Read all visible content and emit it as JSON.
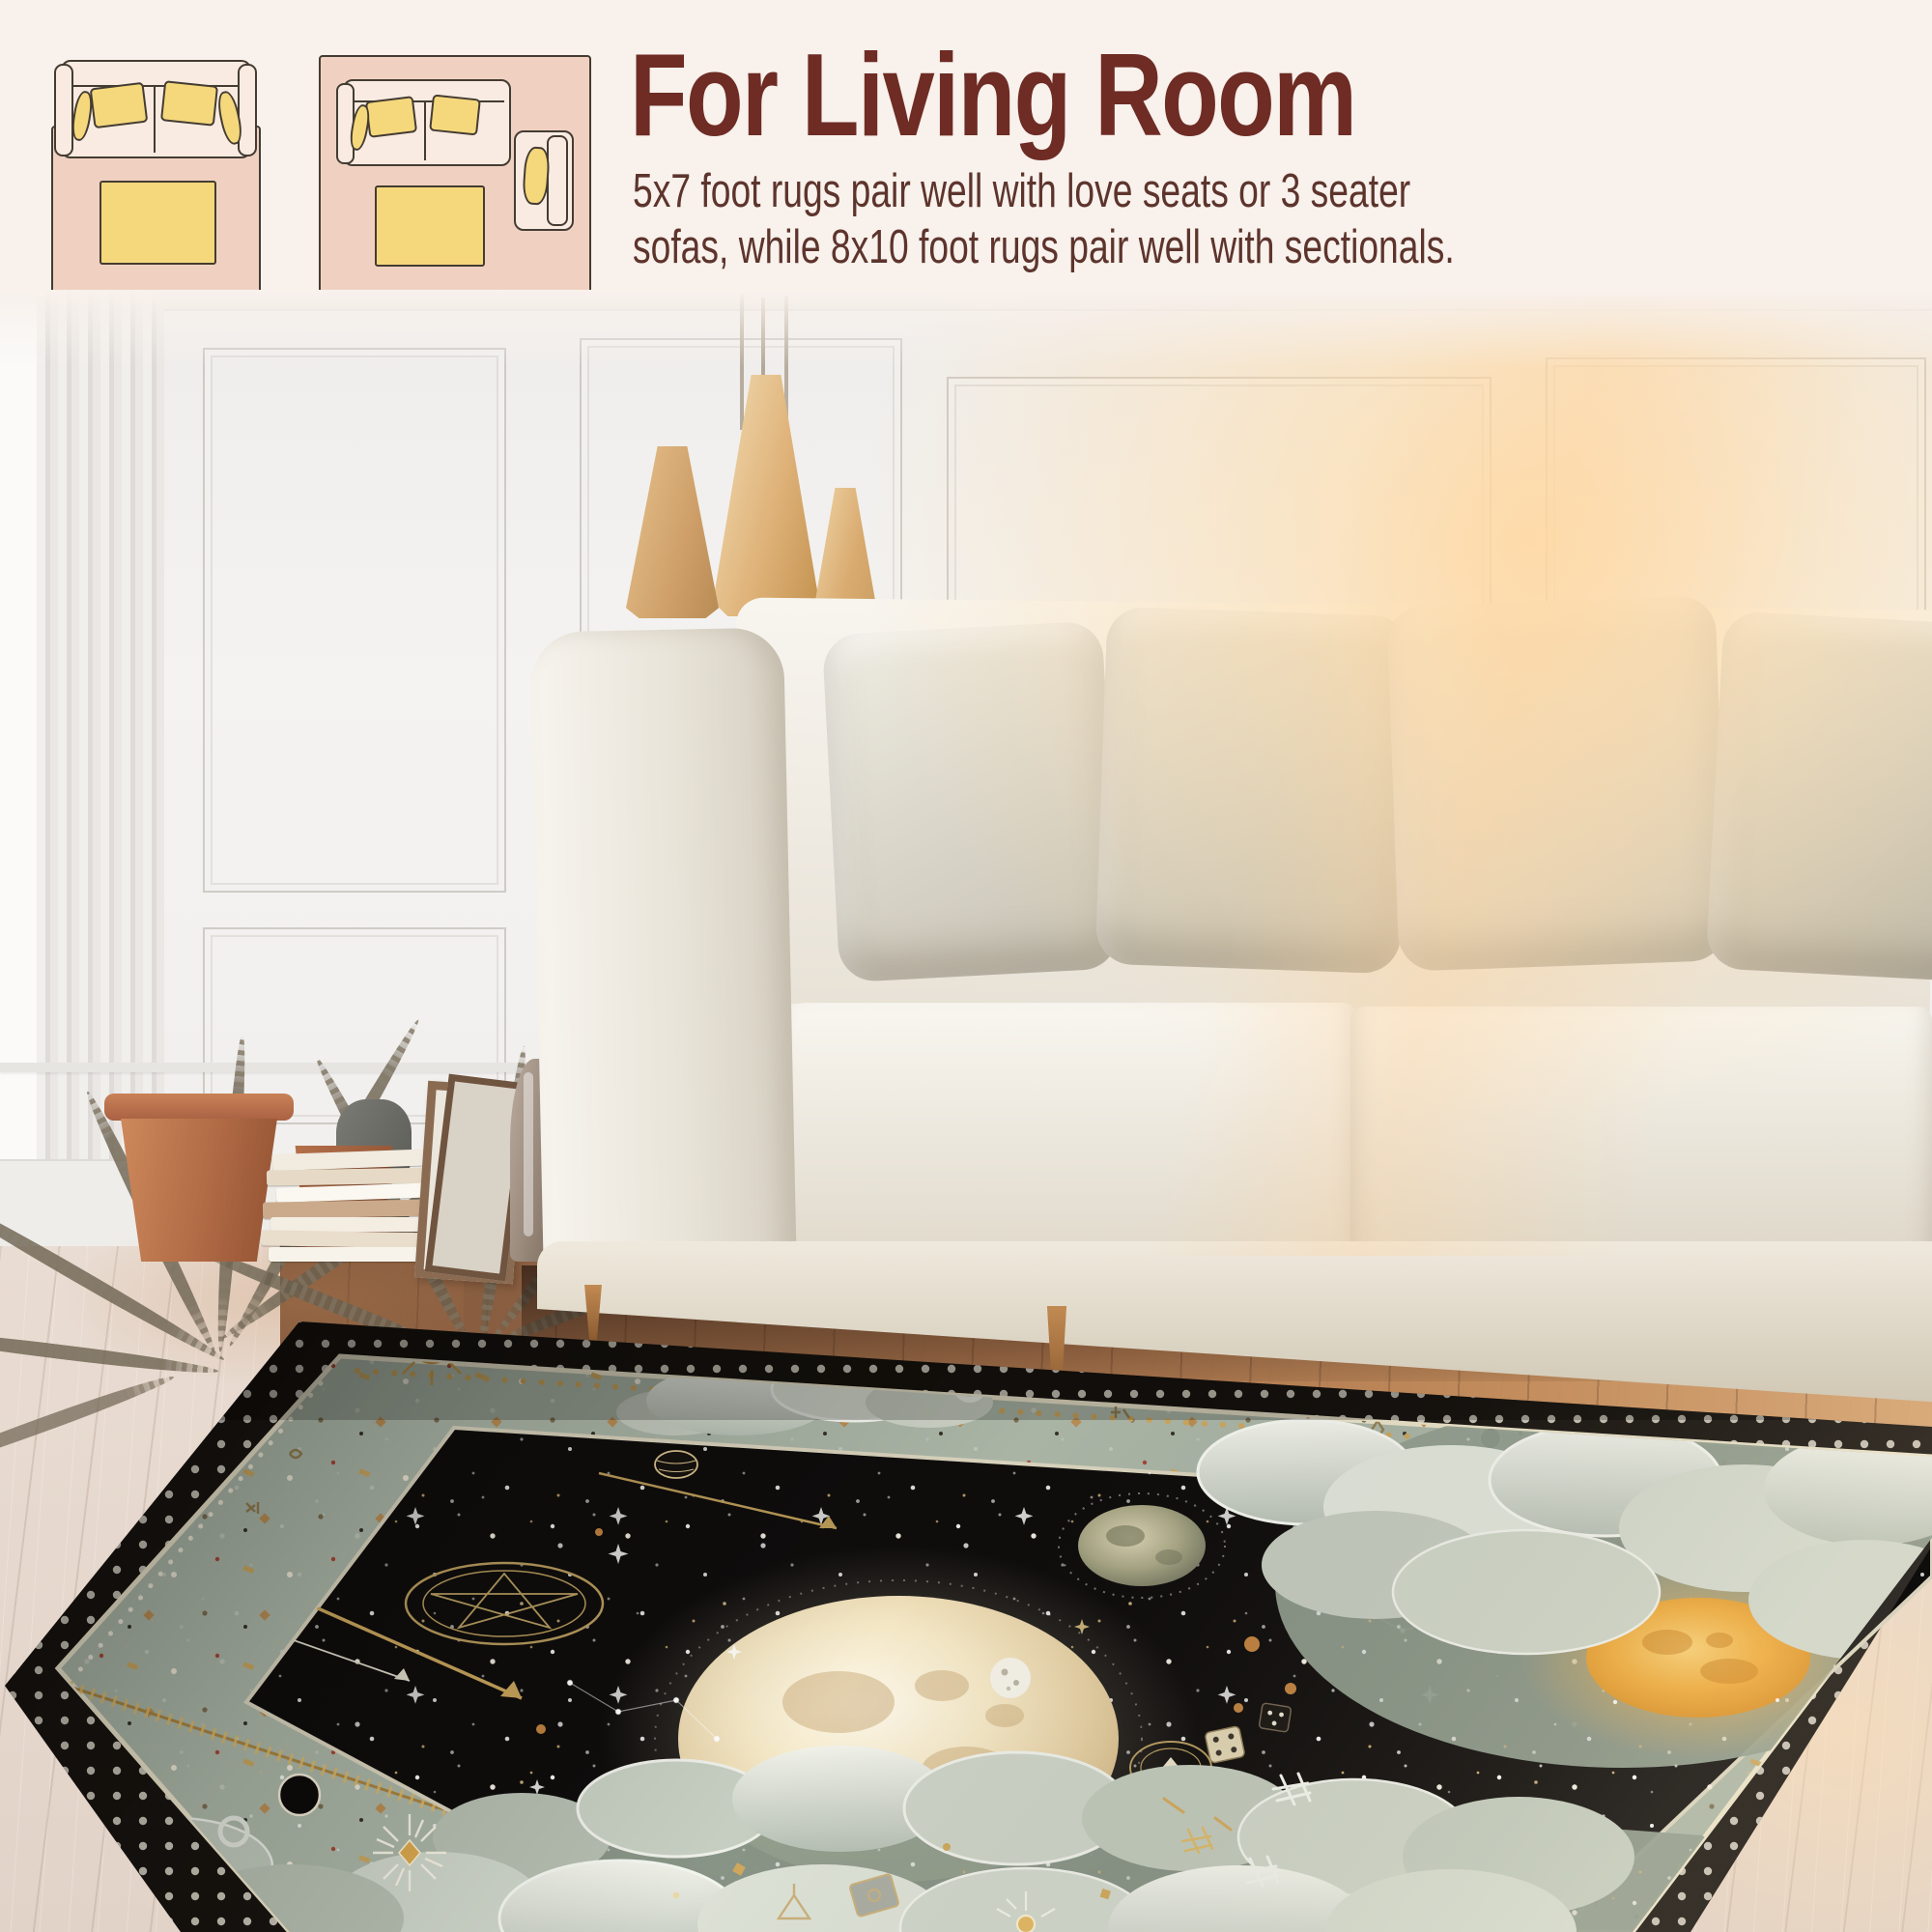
{
  "header": {
    "title": "For Living Room",
    "description_lines": [
      "5x7 foot rugs pair well with love seats or 3 seater",
      "sofas, while 8x10 foot rugs pair well with sectionals."
    ],
    "title_color": "#6e2c24",
    "text_color": "#5d342c"
  },
  "size_diagrams": [
    {
      "label": "5x7",
      "items": [
        "loveseat-sofa",
        "yellow-pillows",
        "coffee-table",
        "pink-rug"
      ]
    },
    {
      "label": "8x10",
      "items": [
        "three-seat-sofa",
        "yellow-pillows",
        "coffee-table",
        "armchair",
        "pink-rug"
      ]
    }
  ],
  "palette": {
    "page_background": "#f8f1ec",
    "diagram_rug_pink": "#f0d1c1",
    "diagram_furniture": "#f9ebe1",
    "diagram_accent_yellow": "#f5d87b",
    "diagram_outline": "#443c33",
    "rug_field_black": "#0f0d0c",
    "rug_border_sage": "#a9b4a5",
    "rug_gold": "#c9a55c",
    "rug_cream": "#ece5d2",
    "sun_orange": "#edaa3c",
    "warm_wood": "#a06a42",
    "pale_floor": "#e6d9cf"
  },
  "scene": {
    "rug_style": "celestial tarot-style rug",
    "rug_motifs": [
      "full-moon",
      "crescent-moon",
      "pentagram-rings",
      "ringed-planet",
      "textured-moon",
      "golden-sun",
      "clouds",
      "star-field",
      "gold-arrows",
      "dice",
      "zipper-trim",
      "eclipse-discs",
      "hash-symbols",
      "sunburst-gem"
    ]
  }
}
